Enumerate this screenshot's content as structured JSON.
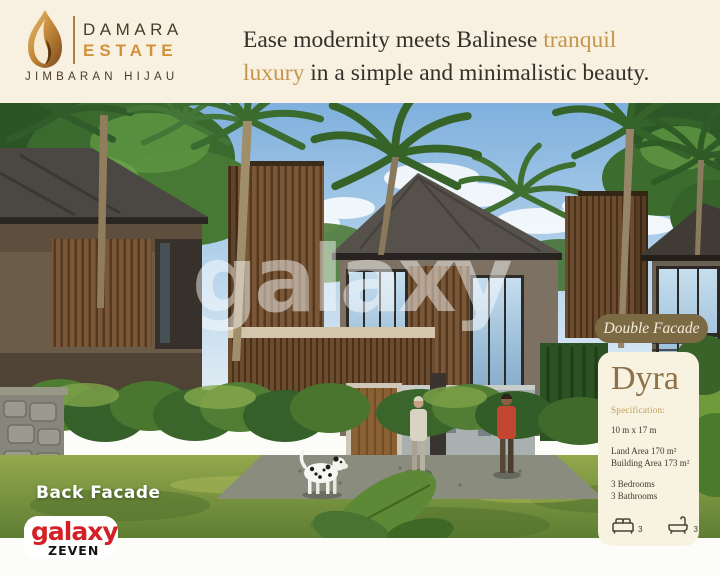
{
  "brand": {
    "name_line1": "DAMARA",
    "name_line2": "ESTATE",
    "subtitle": "JIMBARAN HIJAU"
  },
  "header": {
    "headline_l1_dark": "Ease modernity meets Balinese",
    "headline_l1_gold": " tranquil",
    "headline_l2_gold": "luxury",
    "headline_l2_dark": " in a simple and minimalistic beauty."
  },
  "photo": {
    "label": "Back Facade",
    "watermark": "galaxy"
  },
  "publisher": {
    "name": "galaxy",
    "sub": "ZEVEN"
  },
  "panel": {
    "badge": "Double Facade",
    "title": "Dyra",
    "spec_label": "Specification:",
    "dimensions": "10 m x 17 m",
    "land_area": "Land Area 170 m²",
    "building_area": "Building Area 173 m²",
    "bedrooms": "3 Bedrooms",
    "bathrooms": "3 Bathrooms",
    "bed_count": "3",
    "bath_count": "3"
  },
  "icons": {
    "brand": "flame-icon",
    "bedrooms": "bed-icon",
    "bathrooms": "bathtub-icon"
  },
  "colors": {
    "header_cream": "#f8f1e1",
    "card_cream": "#f8f2e0",
    "badge_olive": "#7c6a45",
    "accent_gold": "#c5954d",
    "brand_orange": "#d2913c",
    "title_brown": "#8d7149",
    "publisher_red": "#d31f26",
    "text_dark": "#33302a"
  }
}
